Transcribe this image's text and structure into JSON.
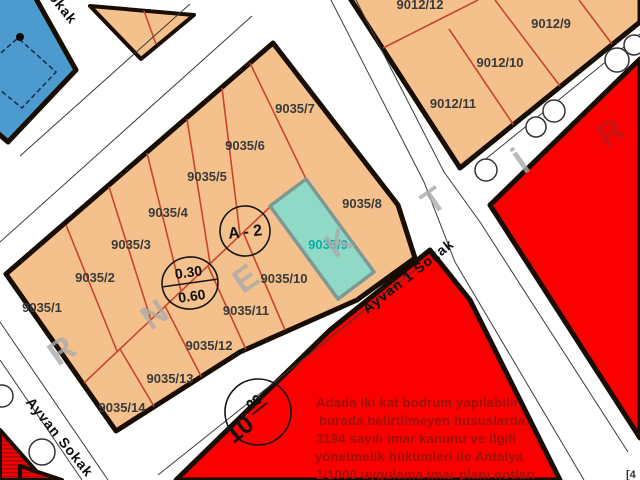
{
  "colors": {
    "parcel_fill": "#f4c18d",
    "parcel_line": "#c8452c",
    "highlight_fill": "#90d9c6",
    "highlight_label": "#0aada2",
    "water_blue": "#4d9ace",
    "red_zone": "#fb0000",
    "note_text": "#9c1208",
    "border": "#170d02"
  },
  "blocks": {
    "b9035": {
      "parcels": {
        "p1": "9035/1",
        "p2": "9035/2",
        "p3": "9035/3",
        "p4": "9035/4",
        "p5": "9035/5",
        "p6": "9035/6",
        "p7": "9035/7",
        "p8": "9035/8",
        "p9": "9035/9",
        "p10": "9035/10",
        "p11": "9035/11",
        "p12": "9035/12",
        "p13": "9035/13",
        "p14": "9035/14"
      },
      "highlighted_parcel": "9035/9"
    },
    "b9012": {
      "parcels": {
        "p9": "9012/9",
        "p10": "9012/10",
        "p11": "9012/11",
        "p12": "9012/12"
      }
    }
  },
  "streets": {
    "ayvan": "Ayvan Sokak",
    "ayvan1": "Ayvan 1 Sokak",
    "partial_top": "Sokak"
  },
  "annotations": {
    "zone": "A - 2",
    "taks": "0.30",
    "kaks": "0.60",
    "road_width": "10",
    "road_width_sup": "00",
    "corner_fragment": "[4"
  },
  "watermark": {
    "word": "ÖRNEKTİR",
    "letters": [
      "R",
      "N",
      "E",
      "K",
      "T",
      "İ",
      "R"
    ]
  },
  "plan_note": {
    "lines": [
      "Adada iki kat bodrum yapılabilir",
      "burada belirtilmeyen hususlarda",
      "3194 sayılı imar kanunu ve ilgili",
      "yönetmelik hükümleri ile Antalya",
      "1/1000 uygulama imar planı notları"
    ]
  }
}
